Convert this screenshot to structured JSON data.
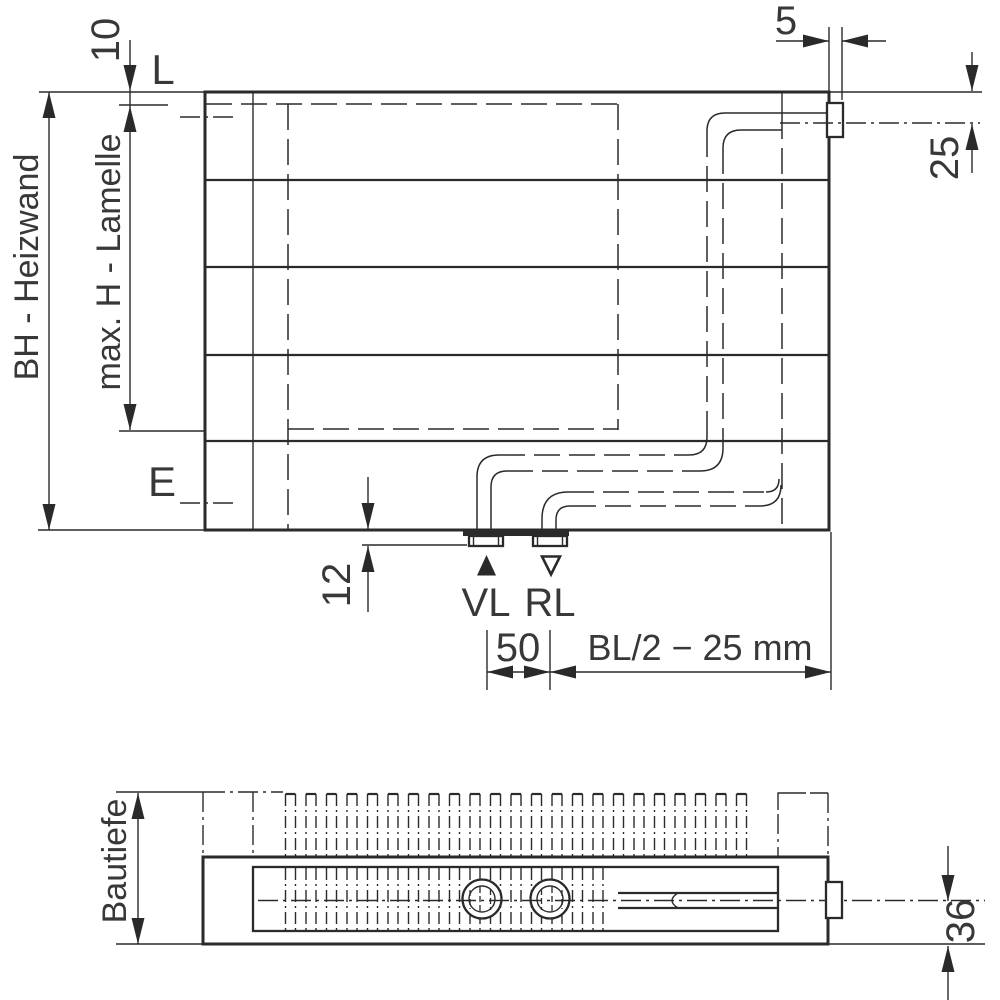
{
  "colors": {
    "line": "#2a2a2a",
    "text": "#383838",
    "background": "#ffffff"
  },
  "front_view": {
    "height_label": "BH - Heizwand",
    "fin_height_label": "max. H - Lamelle",
    "top_gap_dim": "10",
    "top_level_label": "L",
    "bottom_level_label": "E",
    "tab_width_dim": "5",
    "vent_offset_dim": "25",
    "stub_depth_dim": "12",
    "supply_label": "VL",
    "return_label": "RL",
    "connection_spacing_dim": "50",
    "connection_position_dim": "BL/2 − 25 mm"
  },
  "top_view": {
    "depth_label": "Bautiefe",
    "outlet_offset_dim": "36"
  }
}
